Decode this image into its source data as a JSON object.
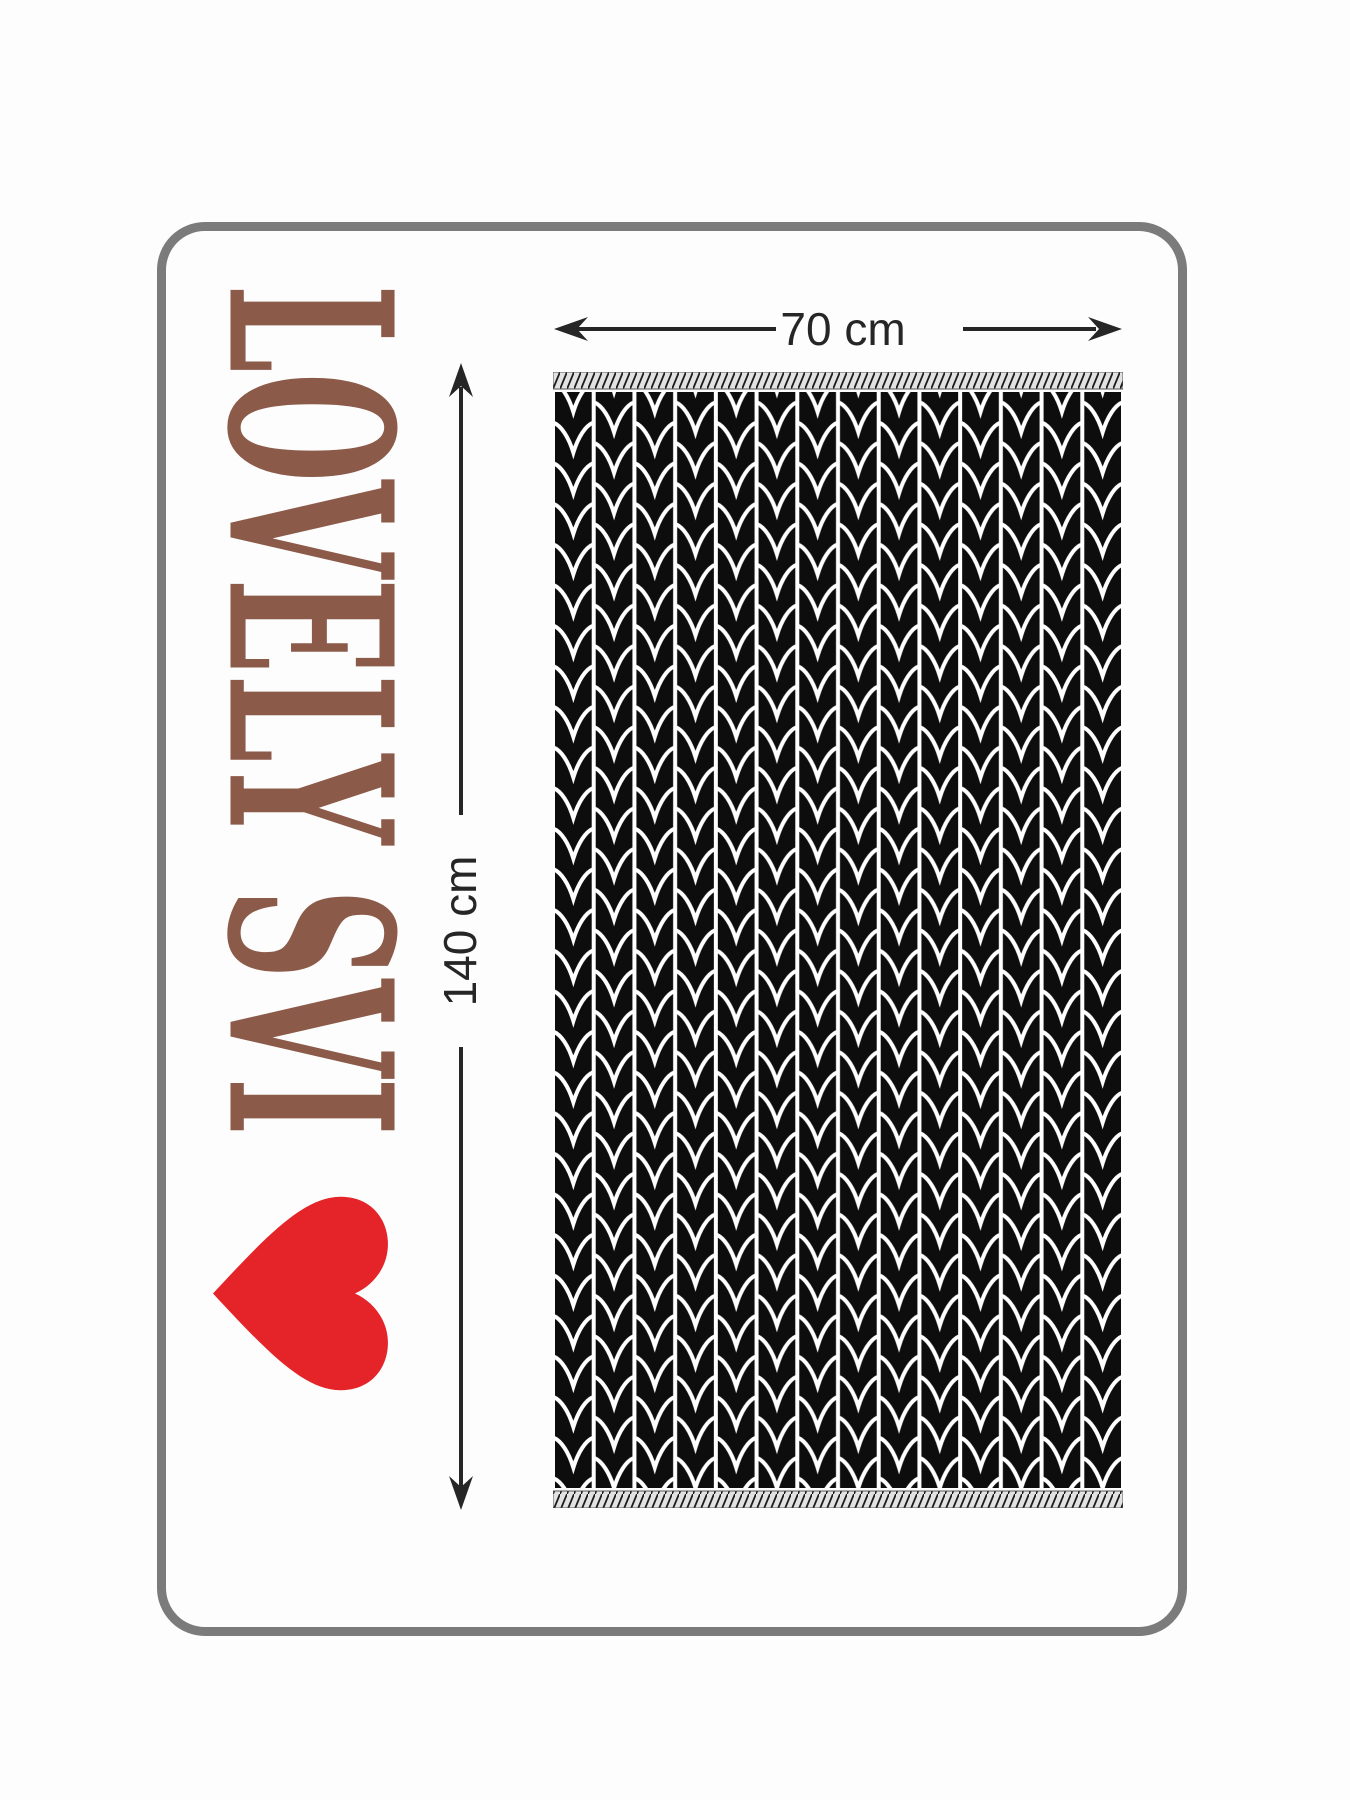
{
  "product_label": {
    "brand_text": "LOVELY SVI",
    "brand_color": "#8B5A49",
    "orientation": "rotated-90-clockwise"
  },
  "heart": {
    "name": "heart-icon",
    "color": "#E42428",
    "orientation": "point-left"
  },
  "dimension_annotations": {
    "width": "70 cm",
    "height": "140 cm",
    "line_color": "#262626"
  },
  "frame": {
    "color": "#7B7B7B",
    "shape": "rounded-rectangle"
  },
  "towel": {
    "pattern": "knit-leaf-herringbone",
    "base_color": "#0D0D0D",
    "stitch_color": "#FFFFFF",
    "border_strip": "diagonal-hatch"
  }
}
